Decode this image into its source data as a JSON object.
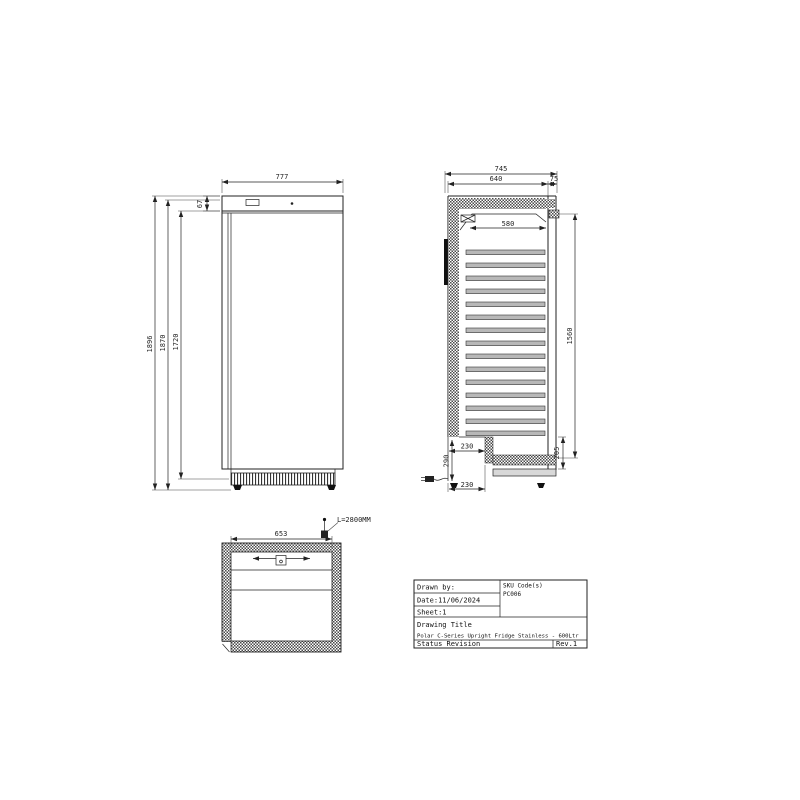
{
  "drawing": {
    "front_view": {
      "dims": {
        "width": "777",
        "header_height": "67",
        "overall_height": "1896",
        "cabinet_height": "1870",
        "door_height": "1720"
      }
    },
    "side_view": {
      "dims": {
        "overall_depth": "745",
        "body_depth": "640",
        "rear_clearance": "75",
        "shelf_depth": "580",
        "interior_height": "1560",
        "base_recess_height": "205",
        "recess_depth_top": "230",
        "recess_depth_bottom": "230",
        "compressor_recess_height": "290"
      }
    },
    "plan_view": {
      "dims": {
        "interior_width": "653"
      },
      "cable_length_label": "L=2800MM"
    },
    "title_block": {
      "drawn_by_label": "Drawn by:",
      "sku_code_label": "SKU Code(s)",
      "sku_code_value": "PC006",
      "date": "Date:11/06/2024",
      "sheet": "Sheet:1",
      "drawing_title_label": "Drawing Title",
      "drawing_title_value": "Polar C-Series Upright Fridge Stainless - 600Ltr",
      "status_label": "Status Revision",
      "revision": "Rev.1"
    },
    "colors": {
      "line": "#222222",
      "shelf_fill": "#b8b8b8",
      "hatch": "#4a4a4a"
    }
  }
}
